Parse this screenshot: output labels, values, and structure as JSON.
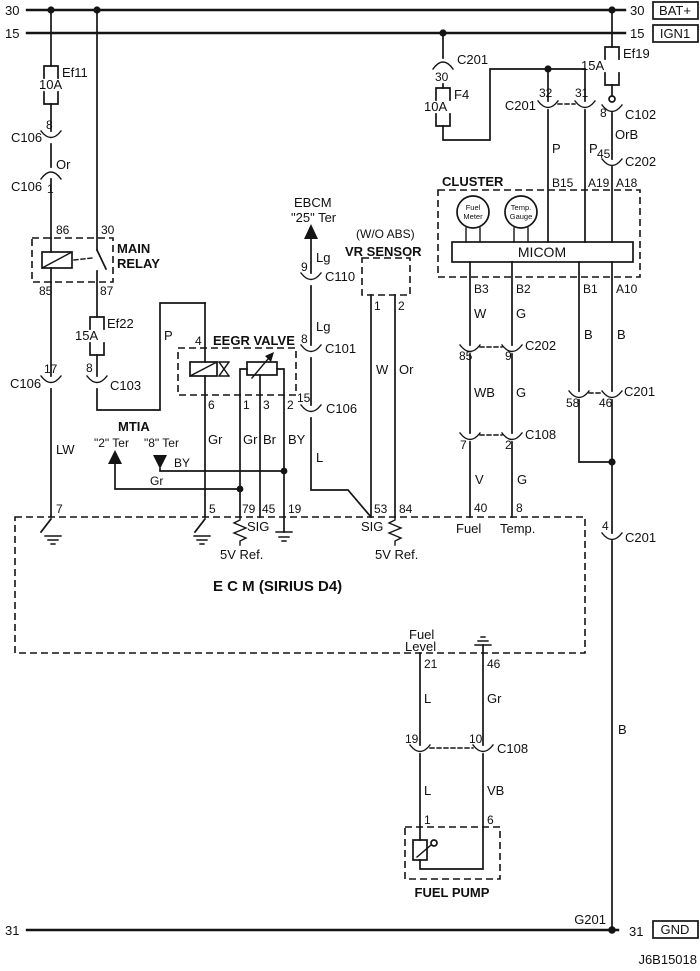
{
  "meta": {
    "code": "J6B15018"
  },
  "rails": {
    "bat": {
      "left": "30",
      "right": "30",
      "tag": "BAT+"
    },
    "ign": {
      "left": "15",
      "right": "15",
      "tag": "IGN1"
    },
    "gnd": {
      "left": "31",
      "right": "31",
      "tag": "GND",
      "ground": "G201"
    }
  },
  "fuses": {
    "ef11": {
      "name": "Ef11",
      "rating": "10A"
    },
    "ef22": {
      "name": "Ef22",
      "rating": "15A"
    },
    "f4": {
      "name": "F4",
      "rating": "10A"
    },
    "ef19": {
      "name": "Ef19",
      "rating": "15A"
    }
  },
  "relay": {
    "name1": "MAIN",
    "name2": "RELAY",
    "pin86": "86",
    "pin30": "30",
    "pin85": "85",
    "pin87": "87"
  },
  "connectors": {
    "c106_8": {
      "name": "C106",
      "pin": "8"
    },
    "c106_1": {
      "name": "C106",
      "pin": "1"
    },
    "c106_17": {
      "name": "C106",
      "pin": "17"
    },
    "c103": {
      "name": "C103",
      "pin": "8"
    },
    "c201_30": {
      "name": "C201",
      "pin": "30"
    },
    "c201_32_31": {
      "name": "C201",
      "pinA": "32",
      "pinB": "31"
    },
    "c102": {
      "name": "C102",
      "pin": "8"
    },
    "c202_45": {
      "name": "C202",
      "pin": "45"
    },
    "c110": {
      "name": "C110",
      "pin": "9"
    },
    "c101": {
      "name": "C101",
      "pin": "8"
    },
    "c106_15": {
      "name": "C106",
      "pin": "15"
    },
    "c202_85_9": {
      "name": "C202",
      "pinA": "85",
      "pinB": "9"
    },
    "c108_7_2": {
      "name": "C108",
      "pinA": "7",
      "pinB": "2"
    },
    "c201_58_46": {
      "name": "C201",
      "pinA": "58",
      "pinB": "46"
    },
    "c201_4": {
      "name": "C201",
      "pin": "4"
    },
    "c108_19_10": {
      "name": "C108",
      "pinA": "19",
      "pinB": "10"
    }
  },
  "wires": {
    "or": "Or",
    "orb": "OrB",
    "lw": "LW",
    "p_main": "P",
    "p_b15": "P",
    "p_a19": "P",
    "lg_upper": "Lg",
    "lg_lower": "Lg",
    "l_sig": "L",
    "w_vr": "W",
    "or_vr": "Or",
    "gr_p6": "Gr",
    "gr_p1": "Gr",
    "br_p3": "Br",
    "by_p2": "BY",
    "by_ter": "BY",
    "gr_ter": "Gr",
    "w_b3": "W",
    "wb": "WB",
    "v": "V",
    "g_b2": "G",
    "g_mid": "G",
    "g_low": "G",
    "b_b1": "B",
    "b_a10": "B",
    "b_gnd": "B",
    "l_21": "L",
    "gr_46": "Gr",
    "l_pump": "L",
    "vb": "VB"
  },
  "ebcm": {
    "line1": "EBCM",
    "line2": "\"25\" Ter"
  },
  "vr": {
    "note": "(W/O ABS)",
    "title": "VR SENSOR",
    "pin1": "1",
    "pin2": "2"
  },
  "mtia": {
    "title": "MTIA",
    "ter2": "\"2\" Ter",
    "ter8": "\"8\" Ter"
  },
  "eegr": {
    "title": "EEGR VALVE",
    "pin4": "4",
    "pin6": "6",
    "pin1": "1",
    "pin3": "3",
    "pin2": "2"
  },
  "cluster": {
    "title": "CLUSTER",
    "micom": "MICOM",
    "fm1": "Fuel",
    "fm2": "Meter",
    "tg1": "Temp.",
    "tg2": "Gauge",
    "b15": "B15",
    "a19": "A19",
    "a18": "A18",
    "b3": "B3",
    "b2": "B2",
    "b1": "B1",
    "a10": "A10"
  },
  "ecm": {
    "title": "E C M (SIRIUS D4)",
    "p7": "7",
    "p5": "5",
    "p79": "79",
    "p45": "45",
    "p19": "19",
    "p53": "53",
    "p84": "84",
    "p40": "40",
    "p8": "8",
    "p21": "21",
    "p46": "46",
    "sig_left": "SIG",
    "sig_right": "SIG",
    "ref_left": "5V Ref.",
    "ref_right": "5V Ref.",
    "fuel": "Fuel",
    "temp": "Temp.",
    "fl1": "Fuel",
    "fl2": "Level"
  },
  "pump": {
    "title": "FUEL PUMP",
    "pin1": "1",
    "pin6": "6"
  }
}
